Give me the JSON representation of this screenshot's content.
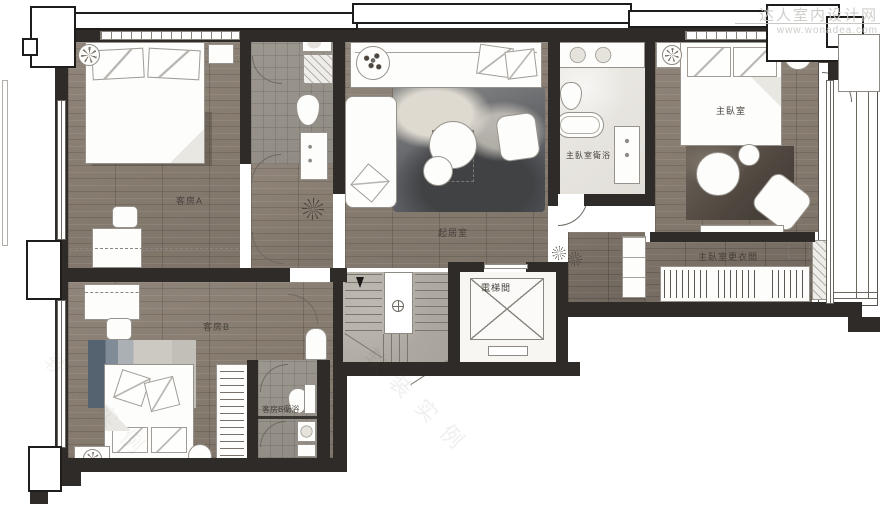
{
  "watermark": {
    "site_name": "达人室内设计网",
    "site_url": "www.wonadea.com",
    "diagonal_text": "软装实例"
  },
  "rooms": [
    {
      "id": "guest_room_a",
      "label": "客房A"
    },
    {
      "id": "living_room",
      "label": "起居室"
    },
    {
      "id": "master_bedroom",
      "label": "主臥室"
    },
    {
      "id": "master_bathroom",
      "label": "主臥室衛浴"
    },
    {
      "id": "master_closet",
      "label": "主臥室更衣間"
    },
    {
      "id": "elevator_room",
      "label": "電梯間"
    },
    {
      "id": "guest_room_b",
      "label": "客房B"
    },
    {
      "id": "guest_b_bathroom",
      "label": "客房B衛浴"
    }
  ],
  "colors": {
    "wall": "#2e2b28",
    "wood_floor": "#877c70",
    "tile_floor": "#97928b",
    "marble_floor": "#eceae5",
    "stair_floor": "#b4afa7",
    "rug_dark": "#4e5156",
    "rug_blue": "#6f7e8c",
    "watermark_gray": "#c8c6c3"
  }
}
